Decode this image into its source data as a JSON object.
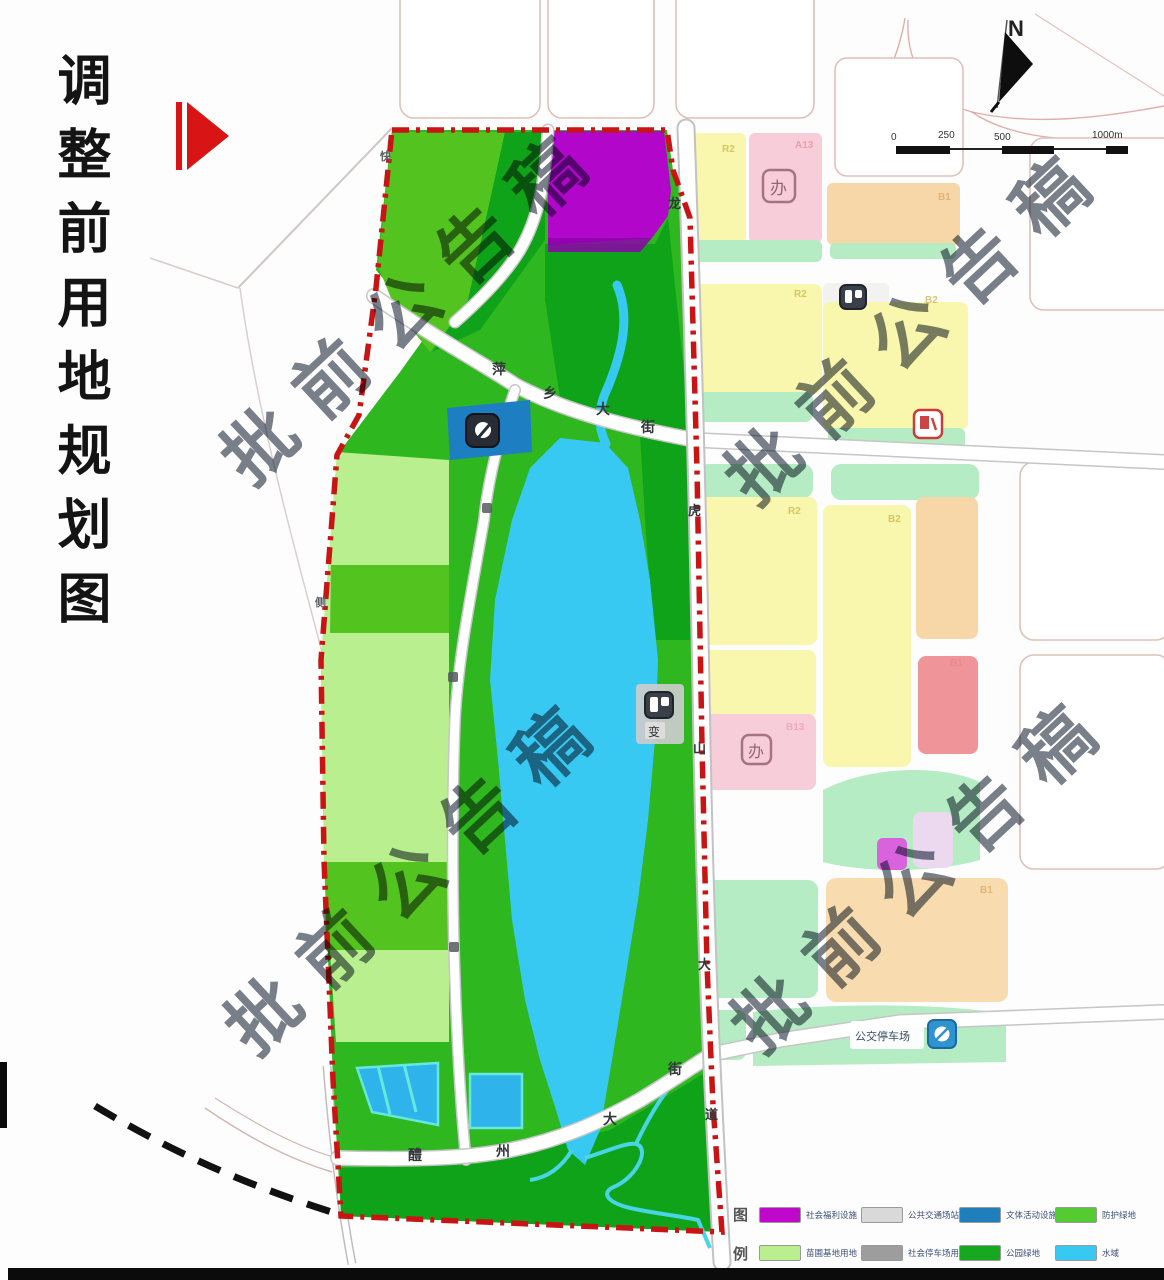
{
  "title": {
    "text": "调整前用地规划图"
  },
  "watermark": {
    "text": "批前公告稿"
  },
  "north": {
    "label": "N"
  },
  "scalebar": {
    "labels": [
      "0",
      "250",
      "500",
      "1000m"
    ]
  },
  "roads": {
    "pingxiang": [
      "萍",
      "乡",
      "大",
      "街"
    ],
    "lizhou": [
      "醴",
      "州",
      "大",
      "街"
    ],
    "longhushan": [
      "龙",
      "虎",
      "山",
      "大",
      "道"
    ],
    "left_road": [
      "快",
      "侧"
    ]
  },
  "labels": {
    "bus_depot": "公交停车场",
    "substation": "变",
    "office_stamp": "办"
  },
  "codes": [
    "R2",
    "A13",
    "B1",
    "R2",
    "B2",
    "R2",
    "B2",
    "B1",
    "B13",
    "B1"
  ],
  "legend": {
    "heading": [
      "图",
      "例"
    ],
    "items": [
      {
        "label": "社会福利设施",
        "color": "#c008cc"
      },
      {
        "label": "公共交通场站用地",
        "color": "#d9d9d9"
      },
      {
        "label": "文体活动设施",
        "color": "#1e7fbc"
      },
      {
        "label": "防护绿地",
        "color": "#54cb31"
      },
      {
        "label": "苗圃基地用地",
        "color": "#b9ef8e"
      },
      {
        "label": "社会停车场用地",
        "color": "#9d9d9d"
      },
      {
        "label": "公园绿地",
        "color": "#16a81f"
      },
      {
        "label": "水域",
        "color": "#38c9f3"
      }
    ]
  },
  "colors": {
    "boundary_red": "#c81414",
    "park_green": "#2eb71f",
    "dark_green": "#0fa31a",
    "medium_green": "#53c41f",
    "pale_green": "#b9ef8e",
    "mint_green": "#b5ecc4",
    "river_cyan": "#38c9f3",
    "teal_block": "#1d7fc2",
    "purple_block": "#b306cb",
    "yellow_block": "#f9f6ad",
    "pink_block": "#f6cdd9",
    "orange_block": "#f7d7a8",
    "red_block": "#ef9499"
  }
}
